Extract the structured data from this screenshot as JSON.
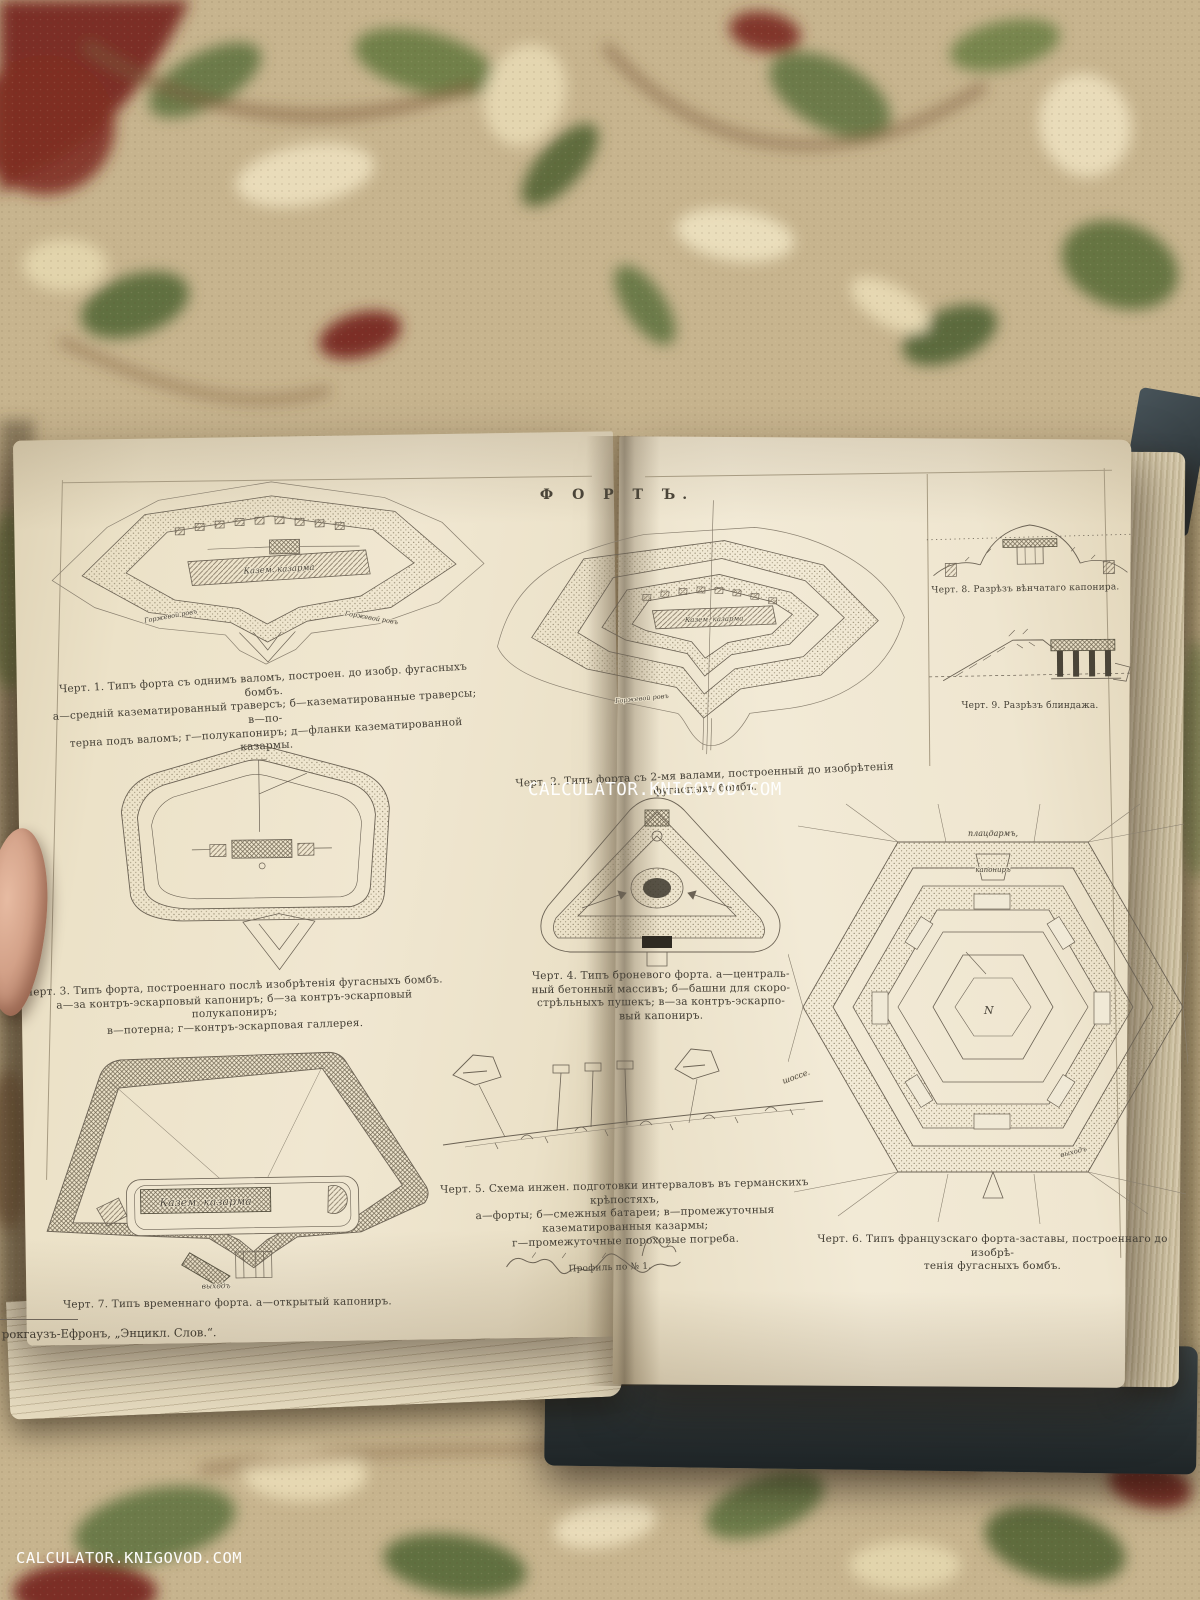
{
  "watermark": {
    "text": "CALCULATOR.KNIGOVOD.COM"
  },
  "plate": {
    "title": "Ф О Р Т Ъ.",
    "publisher_footer": "рокгаузъ-Ефронъ, „Энцикл. Слов.“.",
    "figures": {
      "fig1": {
        "caption": "Черт. 1. Типъ форта съ однимъ валомъ, построен. до изобр. фугасныхъ бомбъ.\nа—средній казематированный траверсъ; б—казематированные траверсы; в—по-\nтерна подъ валомъ; г—полукапониръ; д—фланки казематированной казармы.",
        "labels": {
          "kazarma": "Казем. казарма",
          "ditch_left": "Горжевой ровъ",
          "ditch_right": "Горжевой ровъ"
        }
      },
      "fig2": {
        "caption": "Черт. 2. Типъ форта съ 2-мя валами, построенный до изобрѣтенія фугасныхъ бомбъ.",
        "labels": {
          "kazarma": "Казем. казарма",
          "ditch": "Горжевой ровъ"
        }
      },
      "fig3": {
        "caption": "Черт. 3. Типъ форта, построеннаго послѣ изобрѣтенія фугасныхъ бомбъ.\nа—за контръ-эскарповый капониръ; б—за контръ-эскарповый полукапониръ;\nв—потерна; г—контръ-эскарповая галлерея."
      },
      "fig4": {
        "caption": "Черт. 4. Типъ броневого форта. а—централь-\nный бетонный массивъ; б—башни для скоро-\nстрѣльныхъ пушекъ; в—за контръ-эскарпо-\nвый капониръ."
      },
      "fig5": {
        "caption": "Черт. 5. Схема инжен. подготовки интерваловъ въ германскихъ крѣпостяхъ,\nа—форты; б—смежныя батареи; в—промежуточныя казематированныя казармы;\nг—промежуточные пороховые погреба.",
        "labels": {
          "road": "шоссе."
        }
      },
      "fig6": {
        "caption": "Черт. 6. Типъ французскаго форта-заставы, построеннаго до изобрѣ-\nтенія фугасныхъ бомбъ.",
        "labels": {
          "platzdarm": "плацдармъ,",
          "kaponir": "капониръ",
          "north": "N",
          "exit": "выходъ"
        }
      },
      "fig7": {
        "caption": "Черт. 7. Типъ временнаго форта. а—открытый капониръ.",
        "labels": {
          "kazarma": "Казем. казарма",
          "exit": "выходъ"
        }
      },
      "fig8": {
        "caption": "Черт. 8. Разрѣзъ вѣнчатаго капонира."
      },
      "fig9": {
        "caption": "Черт. 9. Разрѣзъ блиндажа."
      },
      "profile": {
        "label": "Профиль по № 1."
      }
    }
  }
}
